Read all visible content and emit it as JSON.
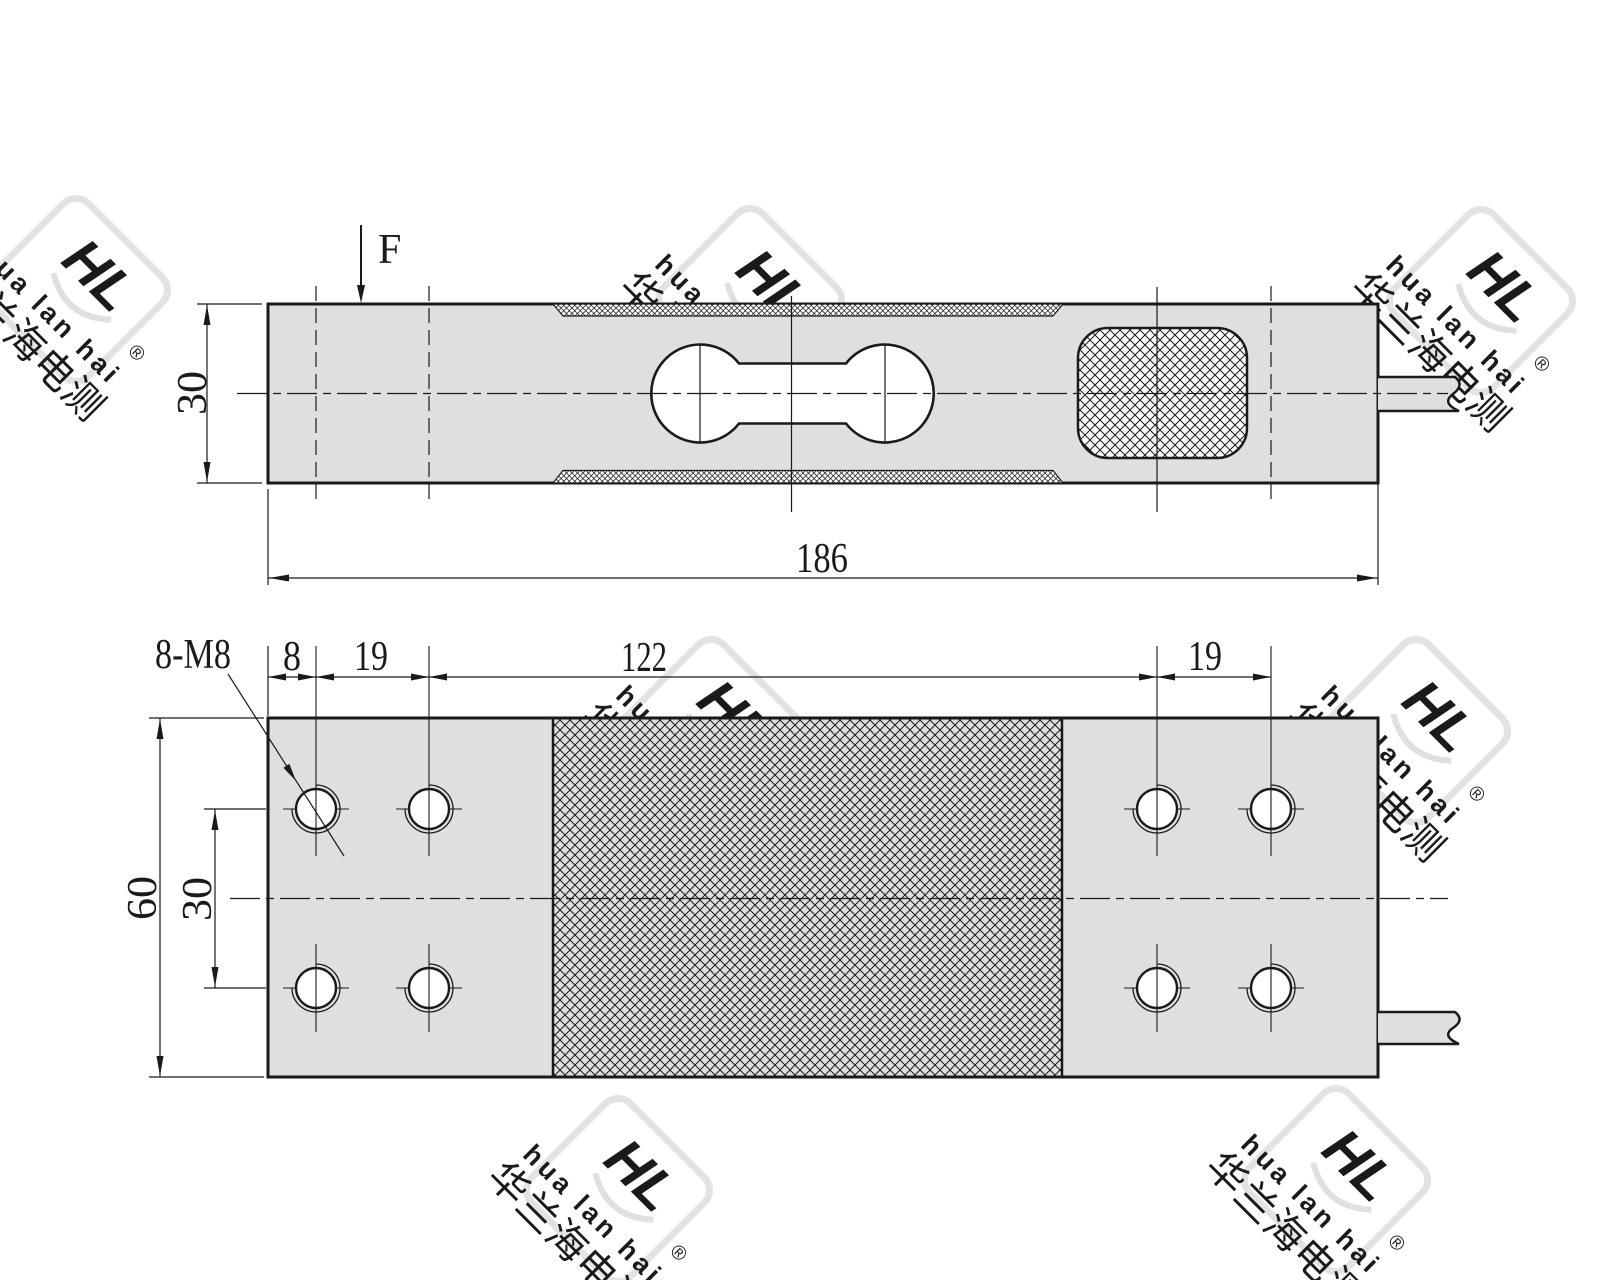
{
  "drawing_title": "single point load cell outline drawing",
  "labels": {
    "force": "F",
    "side_height": "30",
    "side_length": "186",
    "thread_callout": "8-M8",
    "edge_offset": "8",
    "hole_pitch_left": "19",
    "center_span": "122",
    "hole_pitch_right": "19",
    "plan_width": "60",
    "row_spacing": "30"
  },
  "watermark": {
    "brand_logo": "HL",
    "brand_latin": "hua lan hai",
    "registered_mark": "®",
    "brand_chinese": "华兰海电测"
  },
  "colors": {
    "line": "#1a1a1a",
    "metal_fill": "#dfdfdf",
    "hatch_line": "#1a1a1a",
    "watermark": "#e3e3e3",
    "background": "#ffffff"
  }
}
